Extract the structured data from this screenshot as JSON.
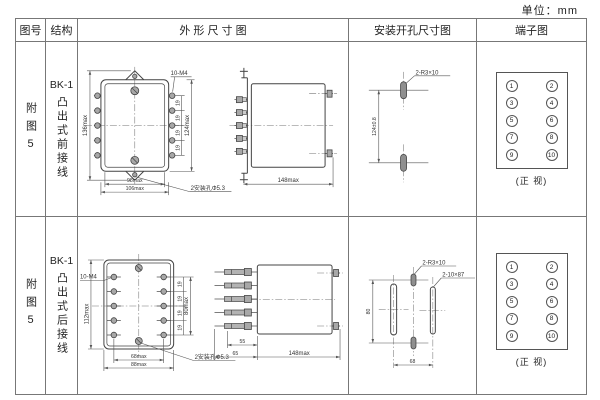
{
  "unit_label": "单位：mm",
  "headers": {
    "fig": "图号",
    "structure": "结构",
    "outline": "外 形 尺 寸 图",
    "mounting": "安装开孔尺寸图",
    "terminal": "端子图"
  },
  "rows": [
    {
      "fig_no": "附图5",
      "model": "BK-1",
      "structure": "凸出式前接线",
      "outline": {
        "height_overall": "136max",
        "thread": "10-M4",
        "pitches": [
          "19",
          "19",
          "19",
          "19"
        ],
        "height_terminals": "124max",
        "width_inner": "98max",
        "width_outer": "106max",
        "hole_note": "2安装孔Φ5.3",
        "depth": "148max"
      },
      "mounting": {
        "slot_note": "2-R3×10",
        "spacing_v": "124±0.8"
      },
      "terminal": {
        "left": [
          "1",
          "3",
          "5",
          "7",
          "9"
        ],
        "right": [
          "2",
          "4",
          "6",
          "8",
          "10"
        ],
        "caption": "(正 视)"
      }
    },
    {
      "fig_no": "附图5",
      "model": "BK-1",
      "structure": "凸出式后接线",
      "outline": {
        "thread": "10-M4",
        "height_overall": "112max",
        "pitches": [
          "19",
          "19",
          "19",
          "19"
        ],
        "height_terminals": "80max",
        "width_inner": "68max",
        "width_outer": "88max",
        "hole_note": "2安装孔Φ5.3",
        "stud_length": "55",
        "flange_depth": "65",
        "depth": "148max"
      },
      "mounting": {
        "slot_note_small": "2-R3×10",
        "slot_note_large": "2-10×87",
        "spacing_v": "80",
        "spacing_h": "68"
      },
      "terminal": {
        "left": [
          "1",
          "3",
          "5",
          "7",
          "9"
        ],
        "right": [
          "2",
          "4",
          "6",
          "8",
          "10"
        ],
        "caption": "(正 视)"
      }
    }
  ]
}
